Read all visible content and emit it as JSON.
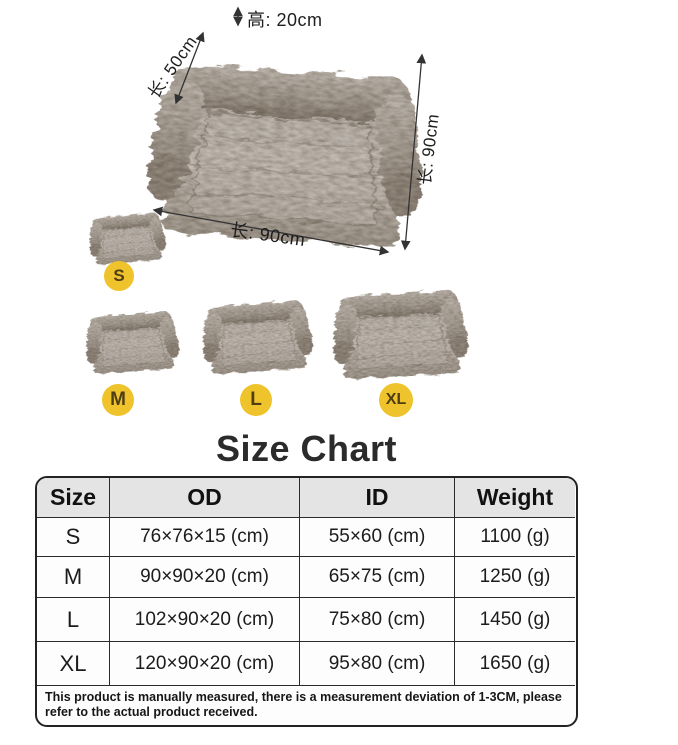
{
  "product_diagram": {
    "dimension_labels": {
      "height": "高: 20cm",
      "backrest": "长: 50cm",
      "side": "长: 90cm",
      "front": "长: 90cm"
    },
    "size_badges": [
      "S",
      "M",
      "L",
      "XL"
    ]
  },
  "size_chart": {
    "title": "Size Chart",
    "note": "This product is manually measured, there is a measurement deviation of 1-3CM, please refer to the actual product received."
  },
  "chart_data": {
    "type": "table",
    "title": "Size Chart",
    "columns": [
      "Size",
      "OD",
      "ID",
      "Weight"
    ],
    "rows": [
      {
        "size": "S",
        "od": "76×76×15 (cm)",
        "id": "55×60 (cm)",
        "weight": "1100 (g)"
      },
      {
        "size": "M",
        "od": "90×90×20 (cm)",
        "id": "65×75 (cm)",
        "weight": "1250 (g)"
      },
      {
        "size": "L",
        "od": "102×90×20 (cm)",
        "id": "75×80 (cm)",
        "weight": "1450 (g)"
      },
      {
        "size": "XL",
        "od": "120×90×20 (cm)",
        "id": "95×80 (cm)",
        "weight": "1650 (g)"
      }
    ]
  },
  "colors": {
    "badge_bg": "#EFC32B",
    "badge_text": "#4F3D14",
    "table_border": "#232323",
    "header_bg": "#E4E4E4",
    "fur_light": "#DDD6CF",
    "fur_dark": "#8A7F73"
  }
}
